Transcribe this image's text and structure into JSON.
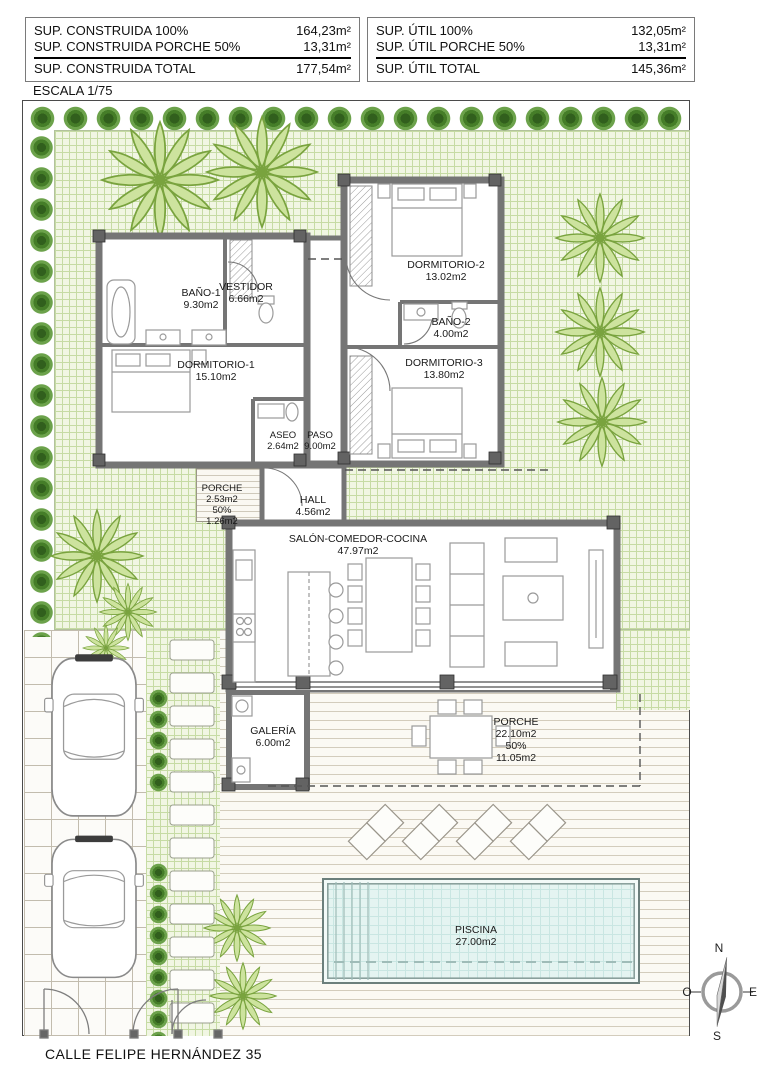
{
  "summary_construida": {
    "rows": [
      {
        "label": "SUP. CONSTRUIDA 100%",
        "value": "164,23m²"
      },
      {
        "label": "SUP. CONSTRUIDA PORCHE 50%",
        "value": "13,31m²"
      }
    ],
    "total": {
      "label": "SUP. CONSTRUIDA TOTAL",
      "value": "177,54m²"
    }
  },
  "summary_util": {
    "rows": [
      {
        "label": "SUP. ÚTIL 100%",
        "value": "132,05m²"
      },
      {
        "label": "SUP. ÚTIL PORCHE 50%",
        "value": "13,31m²"
      }
    ],
    "total": {
      "label": "SUP. ÚTIL TOTAL",
      "value": "145,36m²"
    }
  },
  "escala": "ESCALA 1/75",
  "street_label": "CALLE FELIPE HERNÁNDEZ 35",
  "compass": {
    "north": "N",
    "south": "S",
    "east": "E",
    "west": "O"
  },
  "rooms": {
    "bano1": {
      "name": "BAÑO-1",
      "area": "9.30m2"
    },
    "vestidor": {
      "name": "VESTIDOR",
      "area": "6.66m2"
    },
    "dormitorio1": {
      "name": "DORMITORIO-1",
      "area": "15.10m2"
    },
    "dormitorio2": {
      "name": "DORMITORIO-2",
      "area": "13.02m2"
    },
    "bano2": {
      "name": "BAÑO-2",
      "area": "4.00m2"
    },
    "dormitorio3": {
      "name": "DORMITORIO-3",
      "area": "13.80m2"
    },
    "aseo": {
      "name": "ASEO",
      "area": "2.64m2"
    },
    "paso": {
      "name": "PASO",
      "area": "9.00m2"
    },
    "hall": {
      "name": "HALL",
      "area": "4.56m2"
    },
    "porche_entrada": {
      "name": "PORCHE",
      "area": "2.53m2",
      "pct": "50%",
      "area50": "1.26m2"
    },
    "salon": {
      "name": "SALÓN-COMEDOR-COCINA",
      "area": "47.97m2"
    },
    "galeria": {
      "name": "GALERÍA",
      "area": "6.00m2"
    },
    "porche": {
      "name": "PORCHE",
      "area": "22.10m2",
      "pct": "50%",
      "area50": "11.05m2"
    },
    "piscina": {
      "name": "PISCINA",
      "area": "27.00m2"
    }
  },
  "colors": {
    "lawn_grid": "#c6dba4",
    "bush_dark": "#315f1d",
    "palm_leaf": "#cde39e",
    "palm_stroke": "#79a33e",
    "wall_gray": "#757575",
    "pool_water": "#e4f4f1",
    "deck_line": "#d3ccbc"
  }
}
